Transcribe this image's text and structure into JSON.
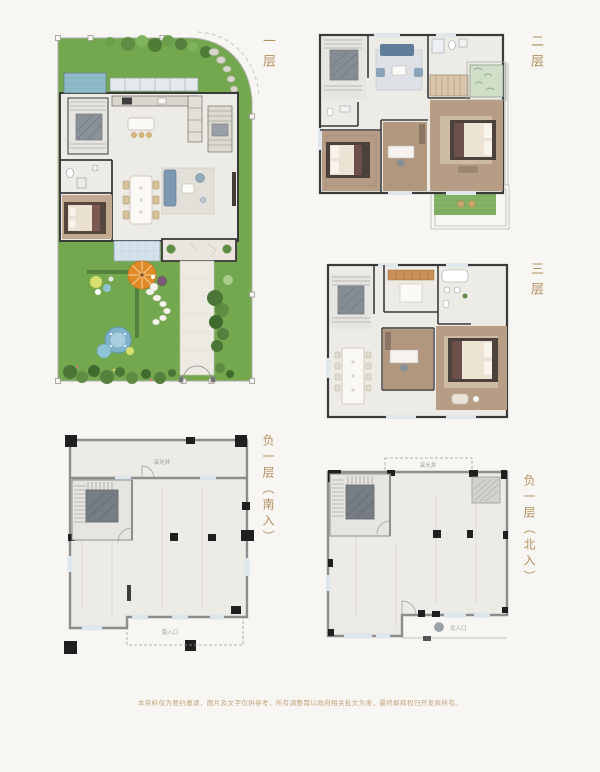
{
  "page": {
    "background": "#f7f6f3"
  },
  "floor_labels": {
    "first": "一层",
    "second": "二层",
    "third": "三层",
    "basement_south": "负一层（南入）",
    "basement_north": "负一层（北入）"
  },
  "annotations": {
    "light_well": "采光井",
    "south_entrance": "南入口",
    "north_entrance": "北入口"
  },
  "footer": {
    "disclaimer": "本资料仅为要约邀请，图片及文字仅供参考，所有调整需以政府相关批文为准，最终解释权归开发商所有。"
  },
  "colors": {
    "label_text": "#b3905f",
    "footer_text": "#c2a57c",
    "lawn_green": "#73a84f",
    "wall_dark": "#3a3a3a",
    "basement_wall_gray": "#8d8d8d",
    "parasol_orange": "#e08a28",
    "water_blue": "#8fbac7",
    "terrace_tile_blue": "#d4e2ec",
    "wood_floor": "#b79d86"
  }
}
